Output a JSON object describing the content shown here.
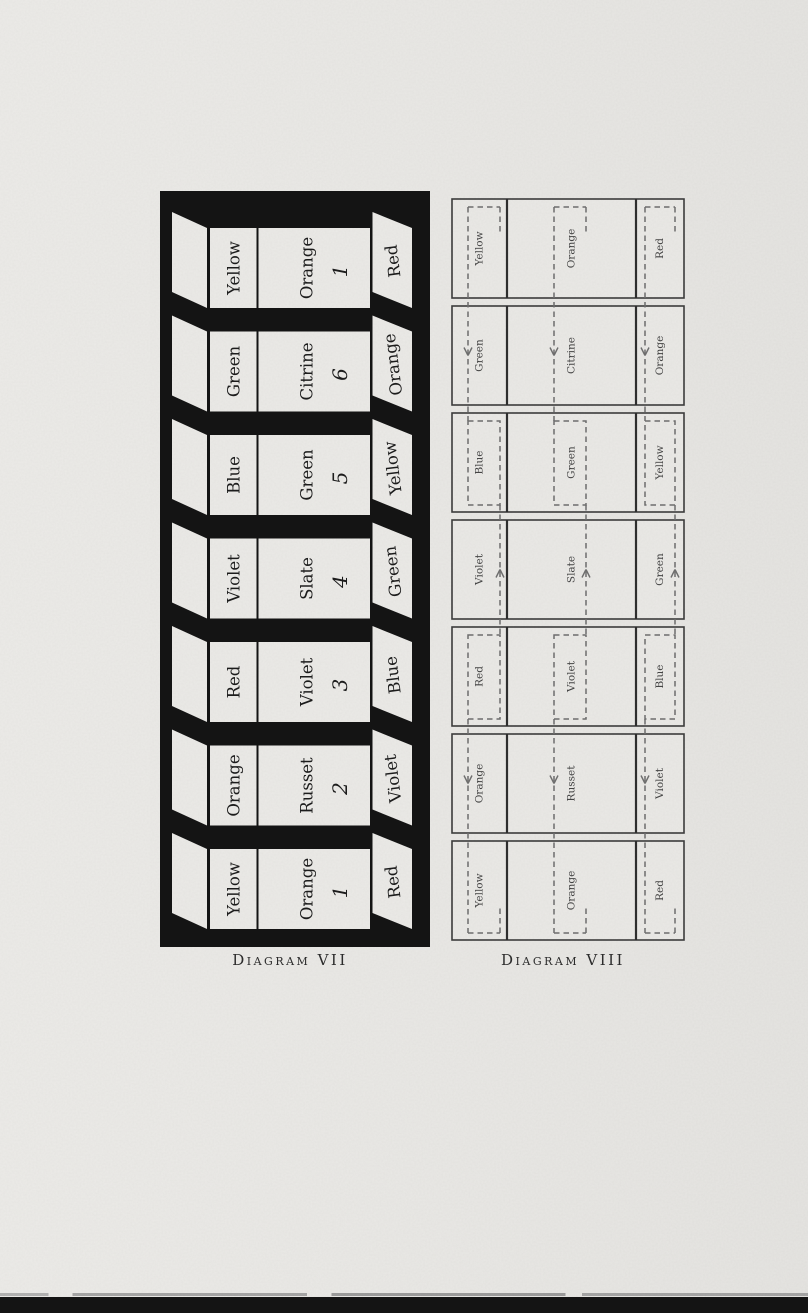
{
  "page": {
    "background": "#e9e8e5",
    "bottom_bar_color": "#141414"
  },
  "diagram_vii": {
    "caption": "Diagram VII",
    "ink": "#141414",
    "paper": "#ebeae7",
    "rows": [
      {
        "col1": "Yellow",
        "col2": "Orange",
        "number": "1",
        "right_flap": "Red"
      },
      {
        "col1": "Green",
        "col2": "Citrine",
        "number": "6",
        "right_flap": "Orange"
      },
      {
        "col1": "Blue",
        "col2": "Green",
        "number": "5",
        "right_flap": "Yellow"
      },
      {
        "col1": "Violet",
        "col2": "Slate",
        "number": "4",
        "right_flap": "Green"
      },
      {
        "col1": "Red",
        "col2": "Violet",
        "number": "3",
        "right_flap": "Blue"
      },
      {
        "col1": "Orange",
        "col2": "Russet",
        "number": "2",
        "right_flap": "Violet"
      },
      {
        "col1": "Yellow",
        "col2": "Orange",
        "number": "1",
        "right_flap": "Red"
      }
    ]
  },
  "diagram_viii": {
    "caption": "Diagram VIII",
    "line_color": "#3c3c3c",
    "dash_color": "#6e6e6e",
    "rows": [
      {
        "col1": "Yellow",
        "col2": "Orange",
        "col3": "Red",
        "marker": "open-rect-top"
      },
      {
        "col1": "Green",
        "col2": "Citrine",
        "col3": "Orange",
        "marker": "arrow-down"
      },
      {
        "col1": "Blue",
        "col2": "Green",
        "col3": "Yellow",
        "marker": "dashed-rect"
      },
      {
        "col1": "Violet",
        "col2": "Slate",
        "col3": "Green",
        "marker": "arrow-up"
      },
      {
        "col1": "Red",
        "col2": "Violet",
        "col3": "Blue",
        "marker": "dashed-rect"
      },
      {
        "col1": "Orange",
        "col2": "Russet",
        "col3": "Violet",
        "marker": "arrow-down"
      },
      {
        "col1": "Yellow",
        "col2": "Orange",
        "col3": "Red",
        "marker": "open-rect-bottom"
      }
    ]
  }
}
